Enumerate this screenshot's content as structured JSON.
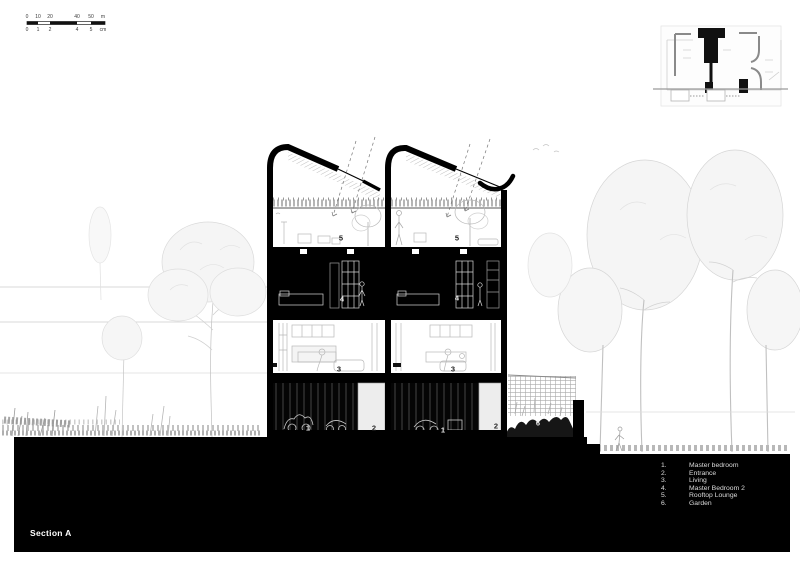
{
  "colors": {
    "paper": "#ffffff",
    "ink": "#000000",
    "sketch_gray": "#c9c9c9",
    "legend_text": "#dcdcdc"
  },
  "section": {
    "title": "Section A"
  },
  "scale_bar": {
    "meter_labels": [
      {
        "t": "0",
        "x": 2
      },
      {
        "t": "10",
        "x": 13
      },
      {
        "t": "20",
        "x": 25
      },
      {
        "t": "40",
        "x": 52
      },
      {
        "t": "50",
        "x": 66
      },
      {
        "t": "m",
        "x": 78
      }
    ],
    "cm_labels": [
      {
        "t": "0",
        "x": 2
      },
      {
        "t": "1",
        "x": 13
      },
      {
        "t": "2",
        "x": 25
      },
      {
        "t": "4",
        "x": 52
      },
      {
        "t": "5",
        "x": 66
      },
      {
        "t": "cm",
        "x": 78
      }
    ]
  },
  "legend": {
    "items": [
      {
        "num": "1.",
        "label": "Master bedroom"
      },
      {
        "num": "2.",
        "label": "Entrance"
      },
      {
        "num": "3.",
        "label": "Living"
      },
      {
        "num": "4.",
        "label": "Master Bedroom 2"
      },
      {
        "num": "5.",
        "label": "Rooftop Lounge"
      },
      {
        "num": "6.",
        "label": "Garden"
      }
    ]
  },
  "room_markers": [
    {
      "t": "5",
      "x": 341,
      "y": 238,
      "color": "#1a1a1a"
    },
    {
      "t": "5",
      "x": 457,
      "y": 238,
      "color": "#1a1a1a"
    },
    {
      "t": "4",
      "x": 342,
      "y": 299,
      "color": "#e8e8e8"
    },
    {
      "t": "4",
      "x": 457,
      "y": 298,
      "color": "#e8e8e8"
    },
    {
      "t": "3",
      "x": 339,
      "y": 369,
      "color": "#1a1a1a"
    },
    {
      "t": "3",
      "x": 453,
      "y": 369,
      "color": "#1a1a1a"
    },
    {
      "t": "1",
      "x": 308,
      "y": 428,
      "color": "#e8e8e8"
    },
    {
      "t": "1",
      "x": 443,
      "y": 430,
      "color": "#e8e8e8"
    },
    {
      "t": "2",
      "x": 374,
      "y": 428,
      "color": "#2a2a2a"
    },
    {
      "t": "2",
      "x": 496,
      "y": 426,
      "color": "#2a2a2a"
    },
    {
      "t": "6",
      "x": 538,
      "y": 423,
      "color": "#e8e8e8"
    }
  ]
}
